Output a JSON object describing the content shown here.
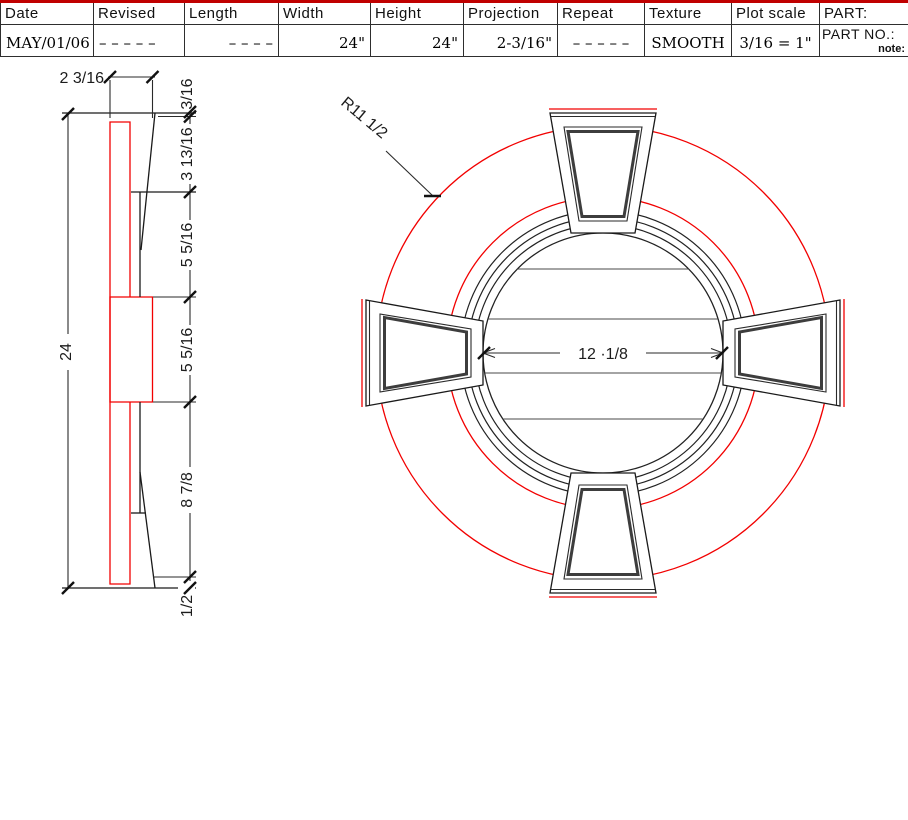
{
  "side_view": {
    "dim_top_width": "2 3/16",
    "dim_overall_height": "24",
    "dims_right": {
      "edge": "3/16",
      "face": "3 13/16",
      "upper_mid": "5 5/16",
      "lower_mid": "5 5/16",
      "lower": "8 7/8",
      "bottom": "1/2"
    }
  },
  "front_view": {
    "radius_label": "R11 1/2",
    "center_width_label": "12 ·1/8"
  },
  "title_block": {
    "columns": [
      {
        "header": "Date",
        "value": "MAY/01/06"
      },
      {
        "header": "Revised",
        "value": "– – – – –"
      },
      {
        "header": "Length",
        "value": "– – – –"
      },
      {
        "header": "Width",
        "value": "24\""
      },
      {
        "header": "Height",
        "value": "24\""
      },
      {
        "header": "Projection",
        "value": "2-3/16\""
      },
      {
        "header": "Repeat",
        "value": "– – – – –"
      },
      {
        "header": "Texture",
        "value": "SMOOTH"
      },
      {
        "header": "Plot scale",
        "value": "3/16 = 1\""
      },
      {
        "header": "PART:",
        "value": "PART NO.:",
        "note": "note:"
      }
    ]
  },
  "colors": {
    "drawing_red": "#f20000",
    "line_black": "#1a1a1a",
    "table_rule_red": "#c00000"
  }
}
